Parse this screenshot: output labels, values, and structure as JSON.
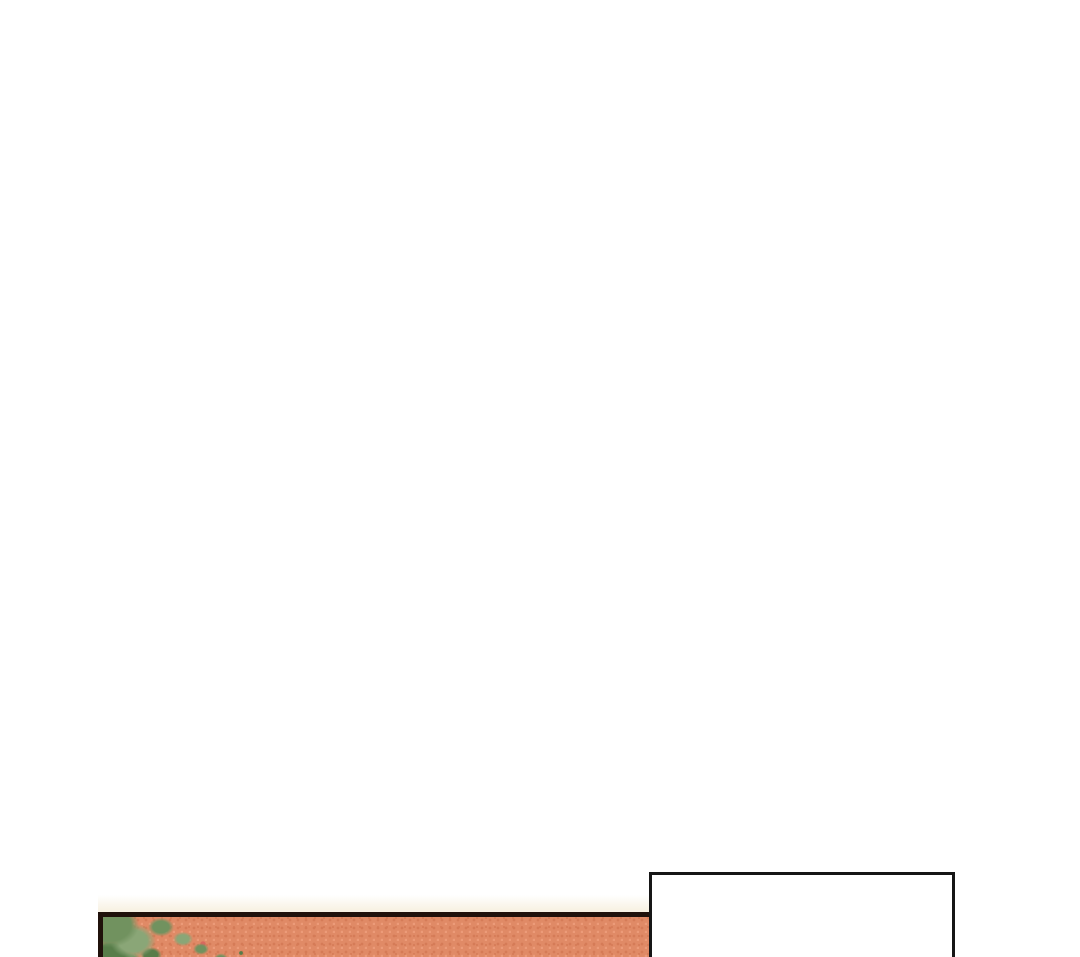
{
  "page": {
    "kind": "webtoon-comic-strip-segment",
    "background_color": "#ffffff"
  },
  "panels": {
    "empty_panel": {
      "description": "blank white comic panel, bottom right, cut off at page bottom",
      "border_color": "#161616",
      "fill_color": "#ffffff"
    },
    "textured_panel": {
      "description": "orange halftone comic panel with green moss in upper-left corner, bottom left, cut off at page bottom",
      "border_color": "#20110b",
      "fill_color": "#e08a66",
      "halftone_dark": "#d57b57",
      "halftone_light": "#ec9b79",
      "moss_green": "#71925f",
      "moss_green_light": "#8aa677",
      "moss_green_dark": "#577d49",
      "accent_speck": "#d9685e",
      "glow_color": "#f8f2e4"
    }
  }
}
